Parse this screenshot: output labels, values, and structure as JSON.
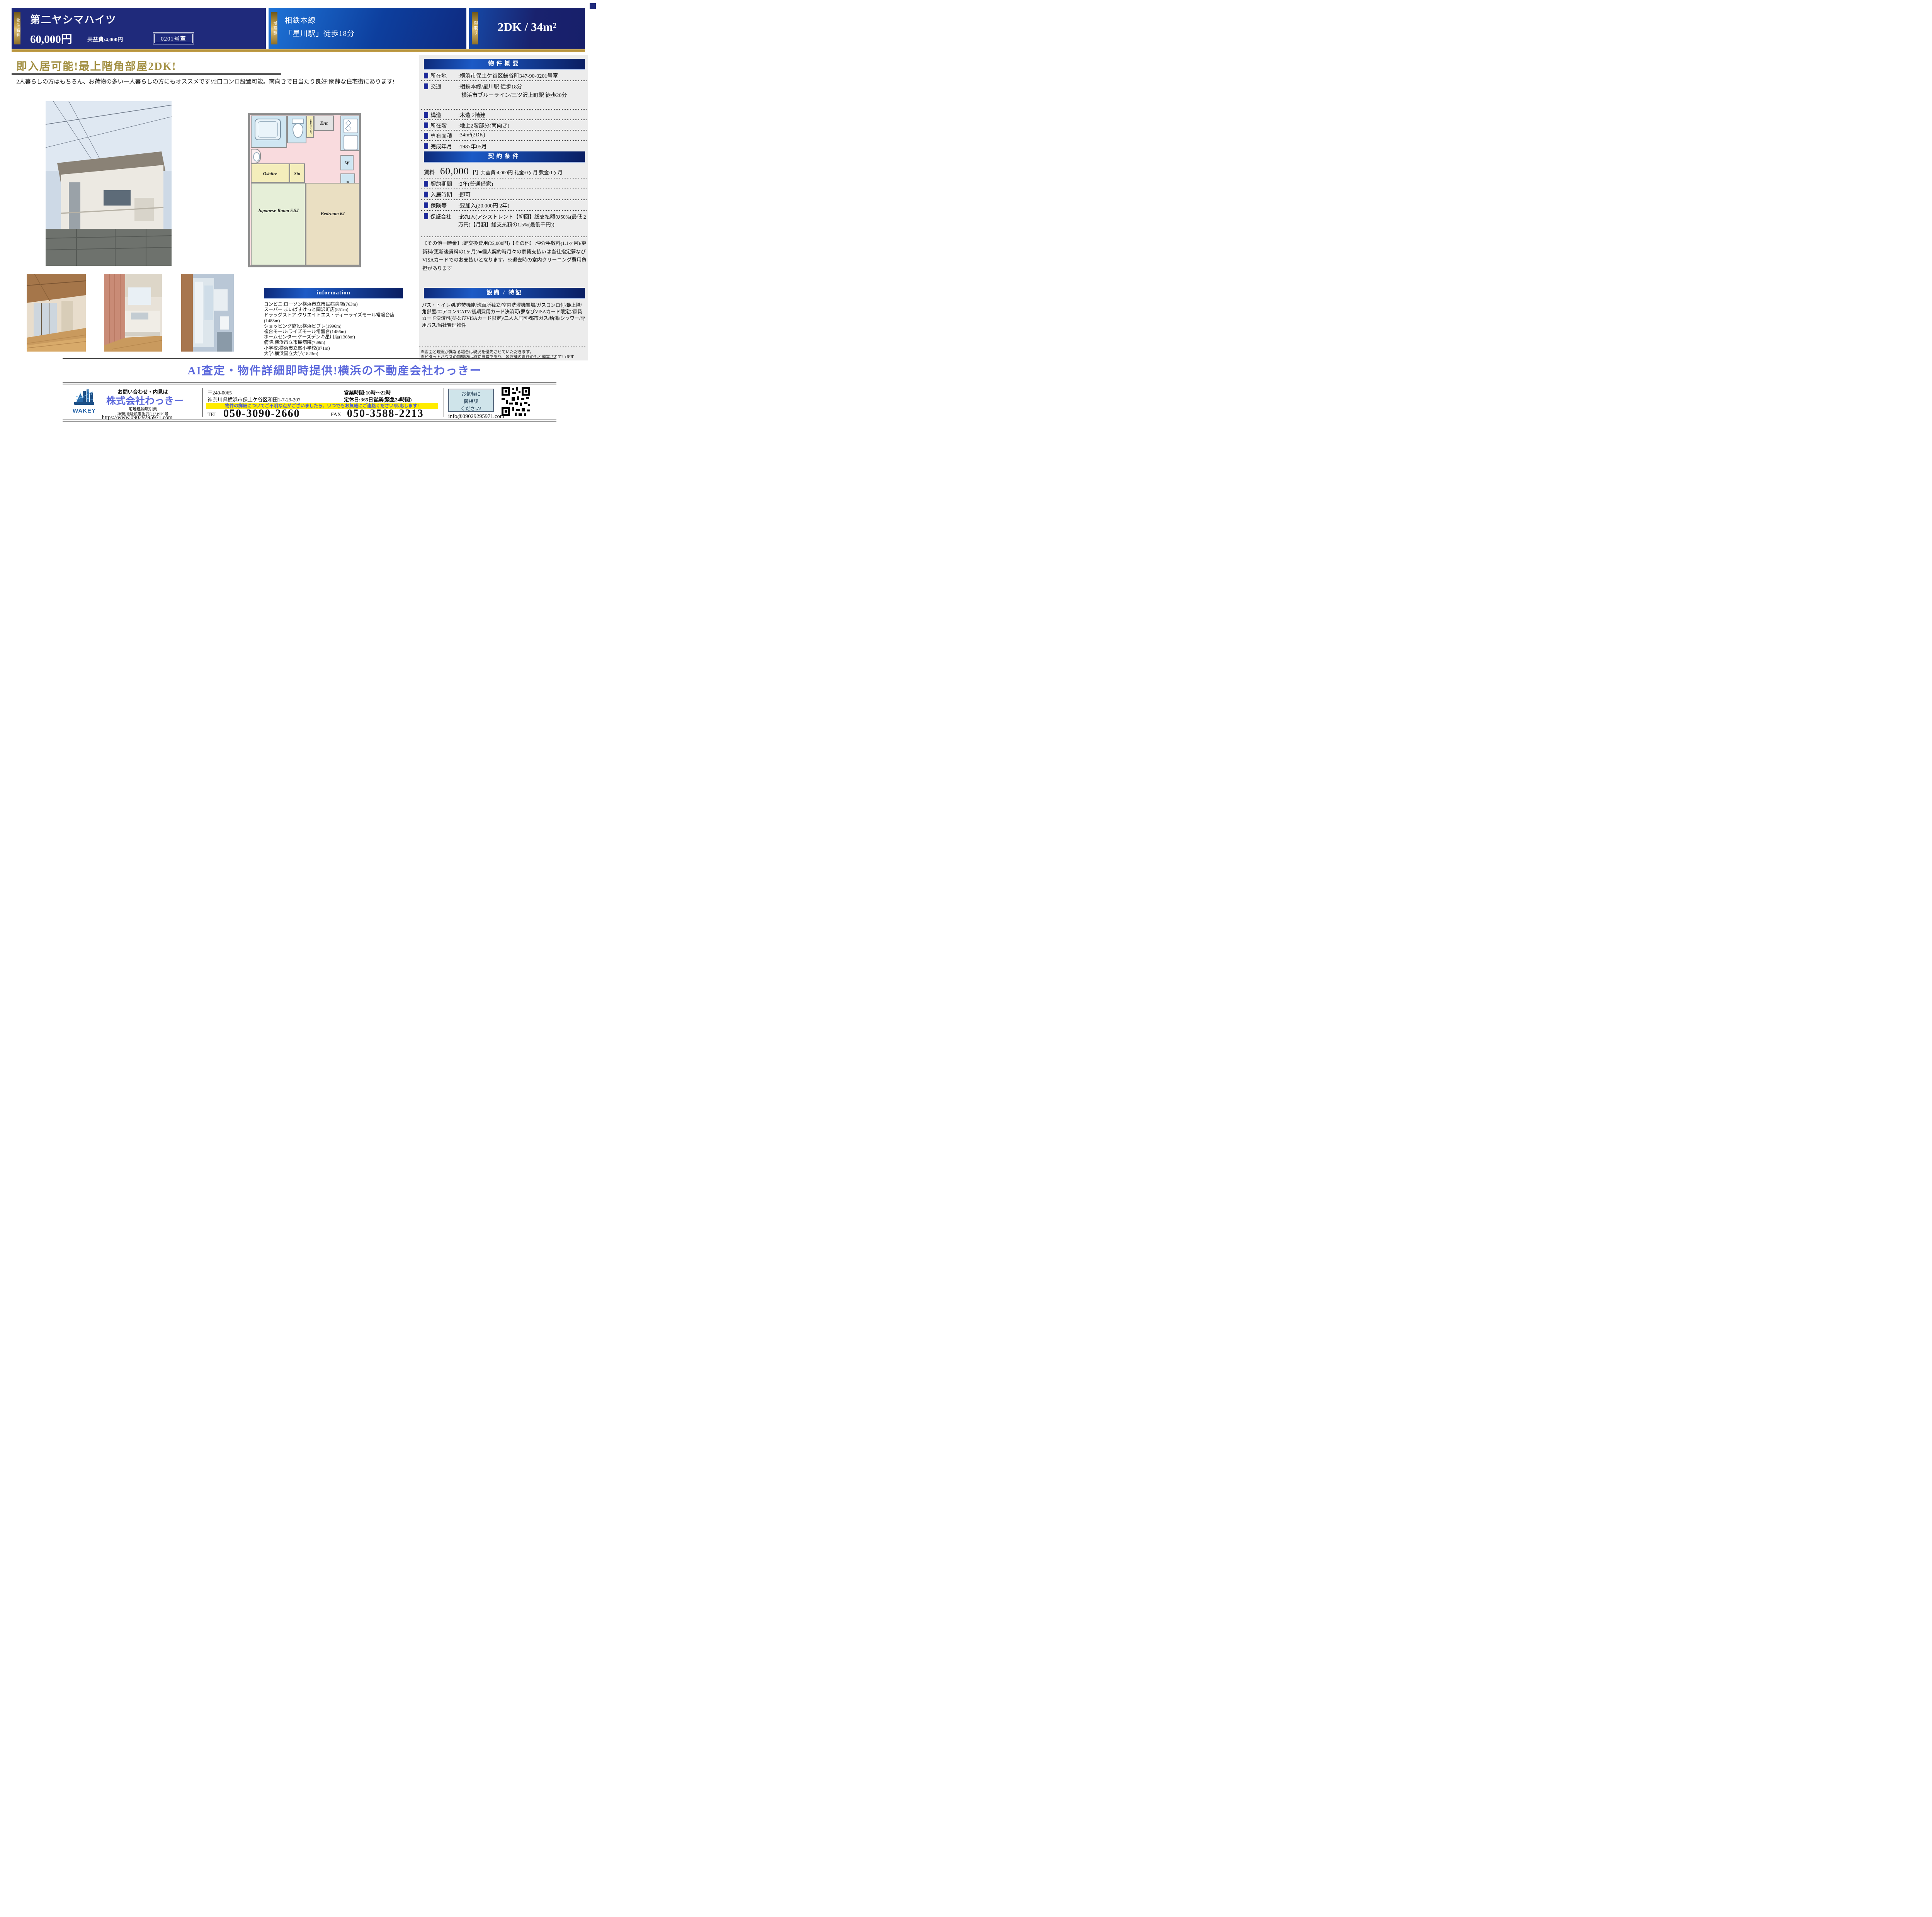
{
  "header": {
    "name_tab": "物件名称",
    "property_name": "第二ヤシマハイツ",
    "price": "60,000円",
    "kyoekihi": "共益費:4,000円",
    "room_no": "0201号室",
    "station_tab": "最寄駅",
    "station_line1": "相鉄本線",
    "station_line2": "「星川駅」徒歩18分",
    "madori_tab": "間取り",
    "madori": "2DK / 34m²"
  },
  "main": {
    "title": "即入居可能!最上階角部屋2DK!",
    "description": "2人暮らしの方はもちろん、お荷物の多い一人暮らしの方にもオススメです!/2口コンロ設置可能。南向きで日当たり良好!閑静な住宅街にあります!"
  },
  "floorplan": {
    "ent": "Ent",
    "shoes_box": "Shoes Box",
    "oshiire": "Oshiire",
    "sto": "Sto",
    "washer": "W",
    "fridge": "R",
    "japanese_room": "Japanese Room 5.5J",
    "bedroom": "Bedroom 6J"
  },
  "overview": {
    "title": "物件概要",
    "rows": [
      {
        "label": "所在地",
        "value": ":横浜市保土ケ谷区鎌谷町347-90-0201号室"
      },
      {
        "label": "交通",
        "value": ":相鉄本線/星川駅 徒歩18分",
        "value2": "横浜市ブルーライン/三ツ沢上町駅 徒歩20分"
      },
      {
        "label": "構造",
        "value": ":木造 2階建"
      },
      {
        "label": "所在階",
        "value": ":地上2階部分(南向き)"
      },
      {
        "label": "専有面積",
        "value": ":34m²(2DK)"
      },
      {
        "label": "完成年月",
        "value": ":1987年05月"
      }
    ]
  },
  "contract": {
    "title": "契約条件",
    "rent_label": "賃料",
    "rent_value": "60,000",
    "rent_unit": "円",
    "rent_detail": "共益費:4,000円 礼金:0ヶ月 敷金:1ヶ月",
    "rows": [
      {
        "label": "契約期間",
        "value": ":2年(普通借家)"
      },
      {
        "label": "入居時期",
        "value": ":即可"
      },
      {
        "label": "保険等",
        "value": ":要加入(20,000円 2年)"
      },
      {
        "label": "保証会社",
        "value": ":必加入(アシストレント【初回】総支払額の50%(最低 2万円)【月額】総支払額の1.5%(最低千円))"
      }
    ],
    "other_fees": "【その他一時金】:鍵交換費用(22,000円)【その他】:仲介手数料(1.1ヶ月)/更新料(更新後賃料の1ヶ月)/■個人契約時月々の家賃支払いは当社指定夢なびVISAカードでのお支払いとなります。※退去時の室内クリーニング費用負担があります"
  },
  "information": {
    "title": "information",
    "items": [
      "コンビニ:ローソン横浜市立市民病院店(763m)",
      "スーパー:まいばすけっと岡沢町店(851m)",
      "ドラッグストア:クリエイトエス・ディーライズモール常磐台店(1483m)",
      "ショッピング施設:横浜ビブレ(1996m)",
      "複合モール:ライズモール常盤台(1486m)",
      "ホームセンター:ケーズデンキ星川店(1308m)",
      "病院:横浜市立市民病院(739m)",
      "小学校:横浜市立峯小学校(871m)",
      "大学:横浜国立大学(1823m)"
    ]
  },
  "facilities": {
    "title": "設備 / 特記",
    "text": "バス・トイレ別/追焚機能/洗面所独立/室内洗濯機置場/ガスコンロ付/最上階/角部屋/エアコン/CATV/初期費用カード決済可(夢なびVISAカード限定)/家賃カード決済可(夢なびVISAカード限定)/二人入居可/都市ガス/給湯/シャワー/専用バス/当社管理物件"
  },
  "notes": {
    "note1": "※図面と現況が異なる場合は現況を優先させていただきます。",
    "note2": "※ピタットハウスの加盟店は独立自営であり、各店舗の責任のもと運営されています"
  },
  "banner": {
    "text": "AI査定・物件詳細即時提供!横浜の不動産会社わっきー"
  },
  "footer": {
    "contact_label": "お問い合わせ・内見は",
    "company": "株式会社わっきー",
    "license1": "宅地建物取引業",
    "license2": "神奈川県知事免許(1)31979号",
    "url": "https://www.09029295971.com",
    "logo_text": "WAKEY",
    "postal": "〒240-0065",
    "address": "神奈川県横浜市保土ケ谷区和田1-7-29-207",
    "hours": "営業時間:10時〜22時",
    "holiday": "定休日:365日営業(緊急24時間)",
    "notice": "物件の詳細についてご不明な点がございましたら、いつでもお気軽にご連絡ください!即応します!",
    "tel_label": "TEL",
    "tel": "050-3090-2660",
    "fax_label": "FAX",
    "fax": "050-3588-2213",
    "consult_line1": "お気軽に",
    "consult_line2": "御相談",
    "consult_line3": "ください!",
    "email": "info@09029295971.com"
  },
  "colors": {
    "navy": "#1f2a7b",
    "gold": "#b08c35",
    "title_gold": "#a28f42",
    "accent_blue": "#5b68dc",
    "notice_yellow": "#ffec00",
    "panel_gray": "#ececec"
  }
}
